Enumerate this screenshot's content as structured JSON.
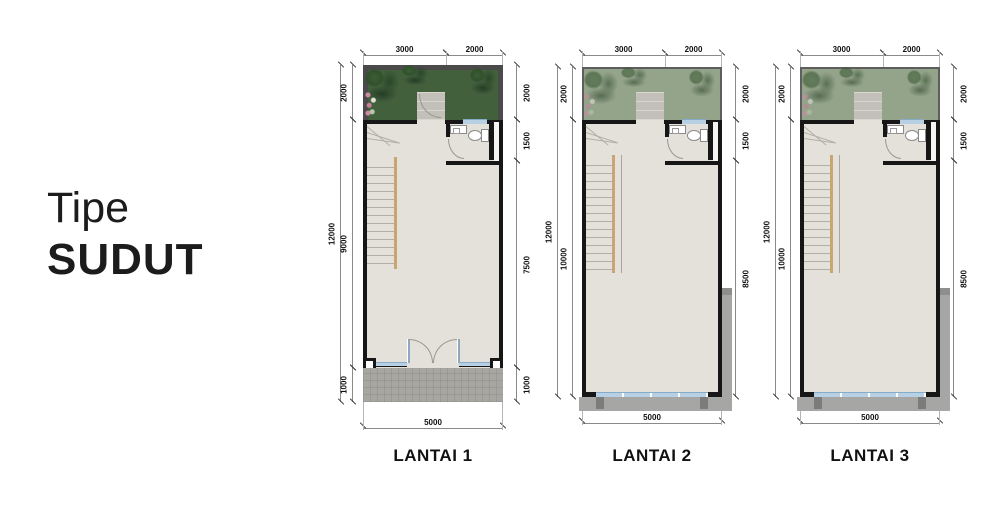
{
  "title": {
    "line1": "Tipe",
    "line2": "SUDUT"
  },
  "plans": [
    {
      "label": "LANTAI 1",
      "dims": {
        "top": [
          "3000",
          "2000"
        ],
        "left_outer": "12000",
        "left": [
          "2000",
          "9000",
          "1000"
        ],
        "right": [
          "2000",
          "1500",
          "7500",
          "1000"
        ],
        "bottom": "5000"
      }
    },
    {
      "label": "LANTAI 2",
      "dims": {
        "top": [
          "3000",
          "2000"
        ],
        "left_outer": "12000",
        "left": [
          "2000",
          "10000"
        ],
        "right": [
          "2000",
          "1500",
          "8500"
        ],
        "bottom": "5000"
      }
    },
    {
      "label": "LANTAI 3",
      "dims": {
        "top": [
          "3000",
          "2000"
        ],
        "left_outer": "12000",
        "left": [
          "2000",
          "10000"
        ],
        "right": [
          "2000",
          "1500",
          "8500"
        ],
        "bottom": "5000"
      }
    }
  ],
  "colors": {
    "wall": "#161616",
    "dimline": "#8a8a8a",
    "dimtext": "#111111",
    "garden1": "#43603d",
    "garden1border": "#4a4a4a",
    "garden2": "#94a48b",
    "garden2border": "#5e5e5e",
    "floor": "#e3e1d9",
    "porch": "#c2c0b9",
    "pavement": "#a8a6a0",
    "ledge": "#a6a6a4",
    "post": "#7c7c7c",
    "window": "#b7d0e4",
    "windowline": "#86abc9",
    "stringer": "#c9a574",
    "tread": "#b2afa6",
    "title": "#1c1c1c",
    "label": "#111111"
  }
}
